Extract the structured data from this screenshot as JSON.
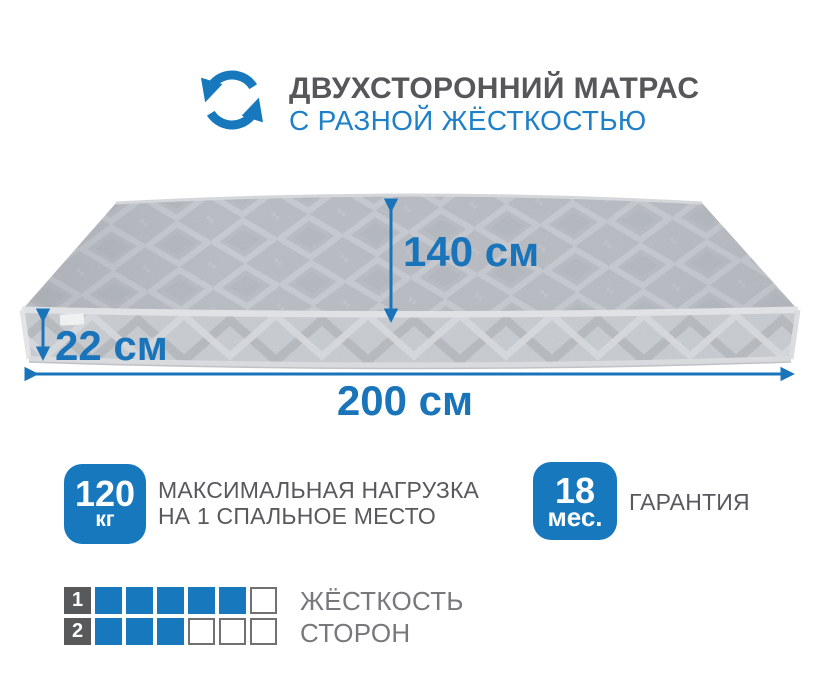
{
  "colors": {
    "accent_blue": "#1878be",
    "subtitle_blue": "#1e80c9",
    "dimension_blue": "#1a74ba",
    "text_gray": "#58595b",
    "grid_text_gray": "#77787a"
  },
  "header": {
    "icon": "rotate-double-sided",
    "title": "ДВУХСТОРОННИЙ МАТРАС",
    "subtitle": "С РАЗНОЙ ЖЁСТКОСТЬЮ"
  },
  "dimensions": {
    "width": "140 см",
    "height": "22 см",
    "length": "200 см"
  },
  "features": [
    {
      "value": "120",
      "unit": "кг",
      "description_line1": "МАКСИМАЛЬНАЯ НАГРУЗКА",
      "description_line2": "НА 1 СПАЛЬНОЕ МЕСТО"
    },
    {
      "value": "18",
      "unit": "мес.",
      "description_line1": "ГАРАНТИЯ",
      "description_line2": ""
    }
  ],
  "hardness": {
    "label_line1": "ЖЁСТКОСТЬ",
    "label_line2": "СТОРОН",
    "rows": [
      {
        "index": "1",
        "filled": 5,
        "total": 6
      },
      {
        "index": "2",
        "filled": 3,
        "total": 6
      }
    ]
  }
}
